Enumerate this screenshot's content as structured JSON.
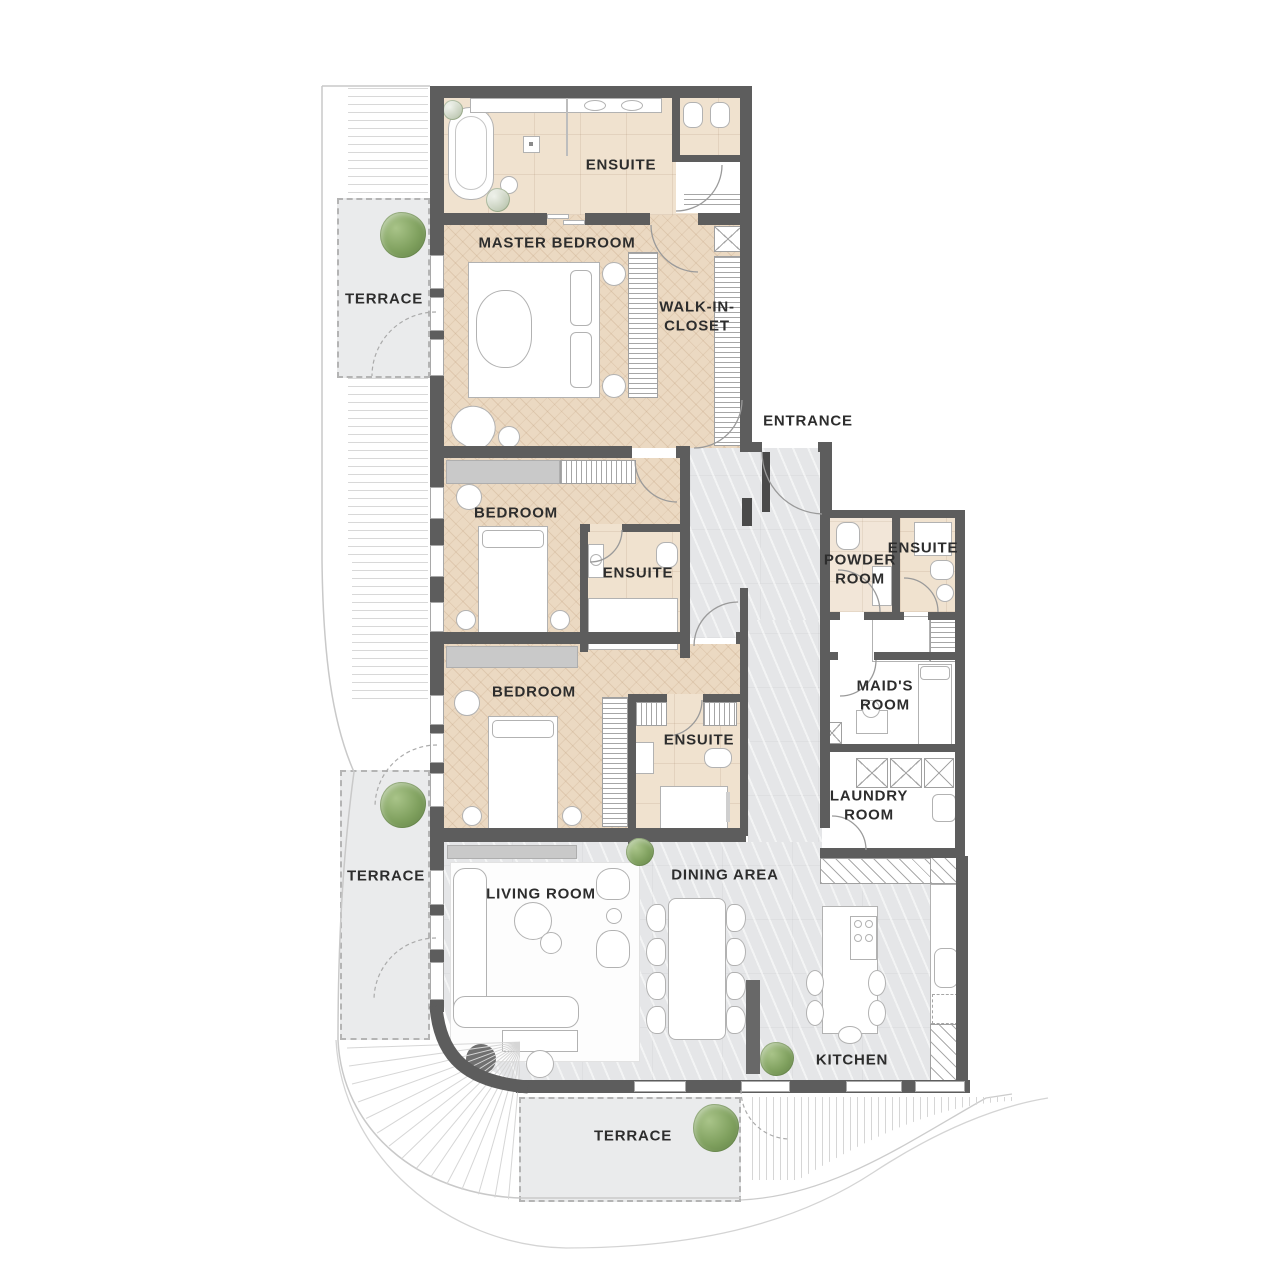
{
  "labels": {
    "ensuite_master": "ENSUITE",
    "master_bedroom": "MASTER BEDROOM",
    "terrace_upper": "TERRACE",
    "walk_in_closet": "WALK-IN-\nCLOSET",
    "entrance": "ENTRANCE",
    "bedroom_2": "BEDROOM",
    "ensuite_2": "ENSUITE",
    "powder_room": "POWDER\nROOM",
    "ensuite_3": "ENSUITE",
    "maids_room": "MAID'S\nROOM",
    "bedroom_3": "BEDROOM",
    "ensuite_4": "ENSUITE",
    "laundry_room": "LAUNDRY\nROOM",
    "terrace_west": "TERRACE",
    "living_room": "LIVING ROOM",
    "dining_area": "DINING AREA",
    "kitchen": "KITCHEN",
    "terrace_south": "TERRACE"
  },
  "colors": {
    "wall": "#5d5d5d",
    "wood": "#ebd9c2",
    "bath": "#f0e2cf",
    "stone": "#e5e6e8",
    "terrace": "#eaebec",
    "label": "#2d2d2d",
    "plant": "#7fa05e"
  }
}
